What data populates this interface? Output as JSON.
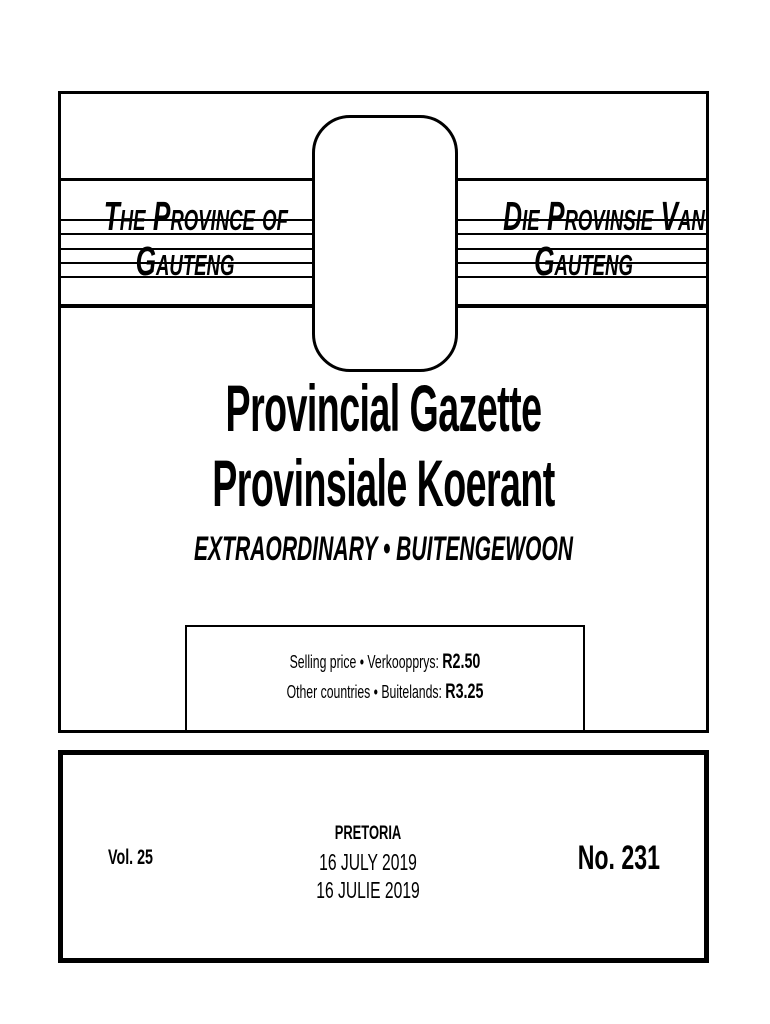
{
  "masthead": {
    "left": {
      "line1": "The Province of",
      "line2": "Gauteng"
    },
    "right": {
      "line1": "Die Provinsie Van",
      "line2": "Gauteng"
    }
  },
  "title": {
    "line1": "Provincial Gazette",
    "line2": "Provinsiale Koerant",
    "subtitle": "EXTRAORDINARY • BUITENGEWOON"
  },
  "price_box": {
    "line1_label": "Selling price • Verkoopprys: ",
    "line1_price": "R2.50",
    "line2_label": "Other countries • Buitelands: ",
    "line2_price": "R3.25"
  },
  "imprint": {
    "volume": "Vol. 25",
    "city": "PRETORIA",
    "date_en": "16 JULY 2019",
    "date_af": "16 JULIE 2019",
    "number": "No. 231"
  },
  "colors": {
    "ink": "#000000",
    "paper": "#ffffff"
  }
}
